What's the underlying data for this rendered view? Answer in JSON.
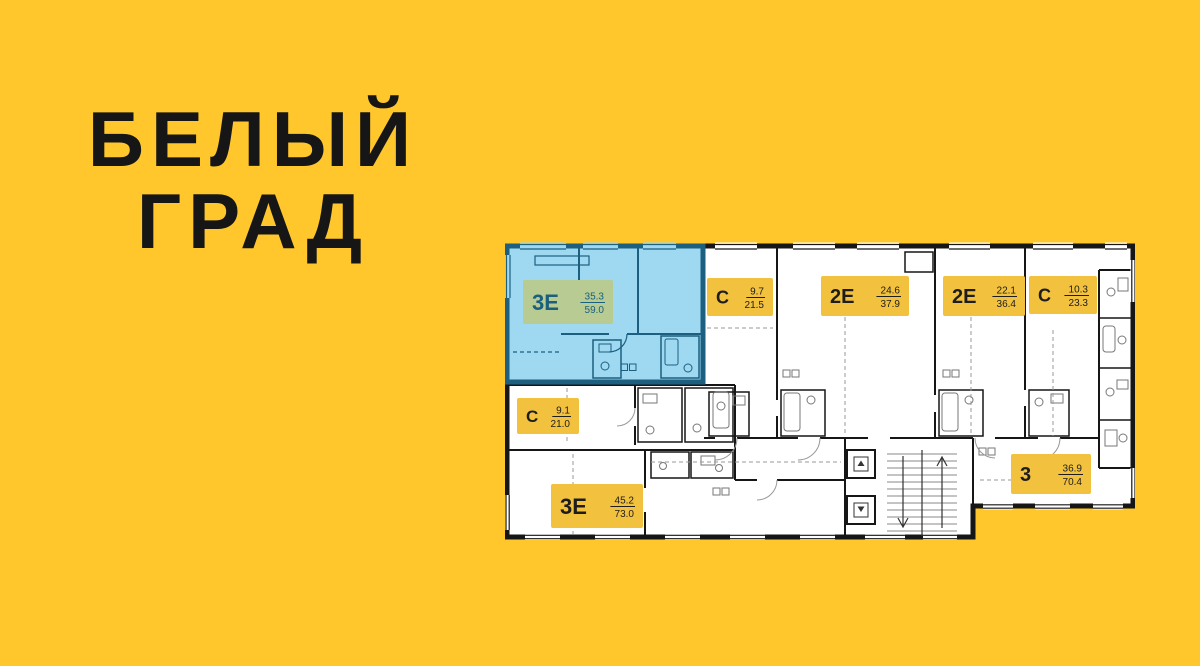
{
  "background_color": "#ffc72c",
  "title": {
    "line1": "БЕЛЫЙ",
    "line2": "ГРАД",
    "color": "#161616"
  },
  "floor_plan": {
    "colors": {
      "wall": "#161616",
      "room_fill": "#ffffff",
      "highlight_fill": "#9ed9f1",
      "highlight_wall": "#1c5f7e",
      "badge_bg": "#f2c13d",
      "badge_text": "#1d1d1d",
      "highlight_badge_bg": "#b7cb92",
      "highlight_badge_text": "#1b5f7e"
    },
    "icons": {
      "elevator_up_glyph": "▲",
      "elevator_down_glyph": "▼"
    },
    "apartments": [
      {
        "id": "3e-59",
        "type": "3Е",
        "area_living": "35.3",
        "area_total": "59.0",
        "highlighted": true,
        "badge": {
          "x": 18,
          "y": 40,
          "w": 90,
          "h": 44,
          "big": 22
        }
      },
      {
        "id": "s-21-5",
        "type": "С",
        "area_living": "9.7",
        "area_total": "21.5",
        "highlighted": false,
        "badge": {
          "x": 202,
          "y": 38,
          "w": 66,
          "h": 38,
          "big": 18
        }
      },
      {
        "id": "2e-37-9",
        "type": "2Е",
        "area_living": "24.6",
        "area_total": "37.9",
        "highlighted": false,
        "badge": {
          "x": 316,
          "y": 36,
          "w": 88,
          "h": 40,
          "big": 20
        }
      },
      {
        "id": "2e-36-4",
        "type": "2Е",
        "area_living": "22.1",
        "area_total": "36.4",
        "highlighted": false,
        "badge": {
          "x": 438,
          "y": 36,
          "w": 82,
          "h": 40,
          "big": 20
        }
      },
      {
        "id": "s-23-3",
        "type": "С",
        "area_living": "10.3",
        "area_total": "23.3",
        "highlighted": false,
        "badge": {
          "x": 524,
          "y": 36,
          "w": 68,
          "h": 38,
          "big": 18
        }
      },
      {
        "id": "s-21-0",
        "type": "С",
        "area_living": "9.1",
        "area_total": "21.0",
        "highlighted": false,
        "badge": {
          "x": 12,
          "y": 158,
          "w": 62,
          "h": 36,
          "big": 17
        }
      },
      {
        "id": "3e-73",
        "type": "3Е",
        "area_living": "45.2",
        "area_total": "73.0",
        "highlighted": false,
        "badge": {
          "x": 46,
          "y": 244,
          "w": 92,
          "h": 44,
          "big": 22
        }
      },
      {
        "id": "3-70-4",
        "type": "3",
        "area_living": "36.9",
        "area_total": "70.4",
        "highlighted": false,
        "badge": {
          "x": 506,
          "y": 214,
          "w": 80,
          "h": 40,
          "big": 20
        }
      }
    ]
  }
}
